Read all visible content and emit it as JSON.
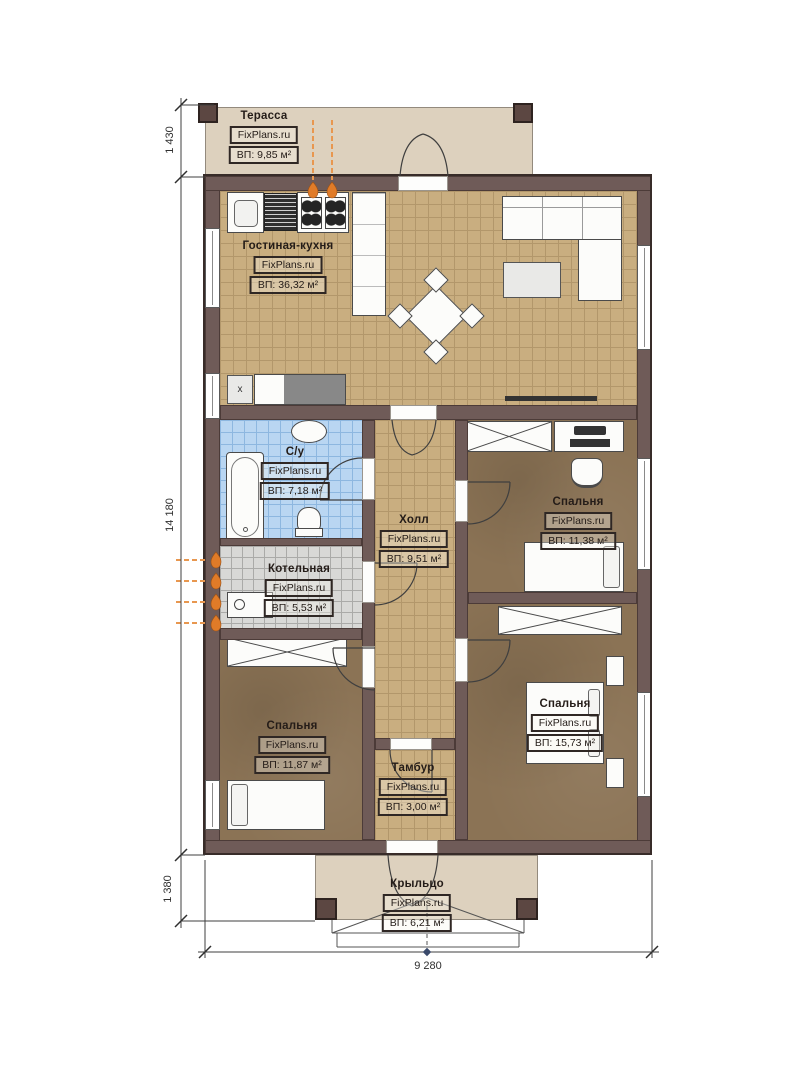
{
  "branding": "FixPlans.ru",
  "rooms": {
    "terrace": {
      "name": "Терасса",
      "area": "ВП: 9,85 м²"
    },
    "living_kitchen": {
      "name": "Гостиная-кухня",
      "area": "ВП: 36,32 м²"
    },
    "bathroom": {
      "name": "С/у",
      "area": "ВП: 7,18 м²"
    },
    "hall": {
      "name": "Холл",
      "area": "ВП: 9,51 м²"
    },
    "bedroom_top_right": {
      "name": "Спальня",
      "area": "ВП: 11,38 м²"
    },
    "boiler_room": {
      "name": "Котельная",
      "area": "ВП: 5,53 м²"
    },
    "bedroom_bottom_left": {
      "name": "Спальня",
      "area": "ВП: 11,87 м²"
    },
    "bedroom_bottom_right": {
      "name": "Спальня",
      "area": "ВП: 15,73 м²"
    },
    "vestibule": {
      "name": "Тамбур",
      "area": "ВП: 3,00 м²"
    },
    "porch": {
      "name": "Крыльцо",
      "area": "ВП: 6,21 м²"
    }
  },
  "dimensions": {
    "left_terrace": "1 430",
    "left_house": "14 180",
    "left_porch": "1 380",
    "bottom_width": "9 280"
  },
  "appliance_mark": "x",
  "colors": {
    "wall": "#6f5b58",
    "floor_wood": "#c9ae80",
    "floor_bedroom": "#8b7355",
    "floor_bath": "#b9d6f2",
    "floor_boiler": "#d8d8d6",
    "floor_outside": "#ddd1be",
    "gas_flame": "#e07b28"
  }
}
